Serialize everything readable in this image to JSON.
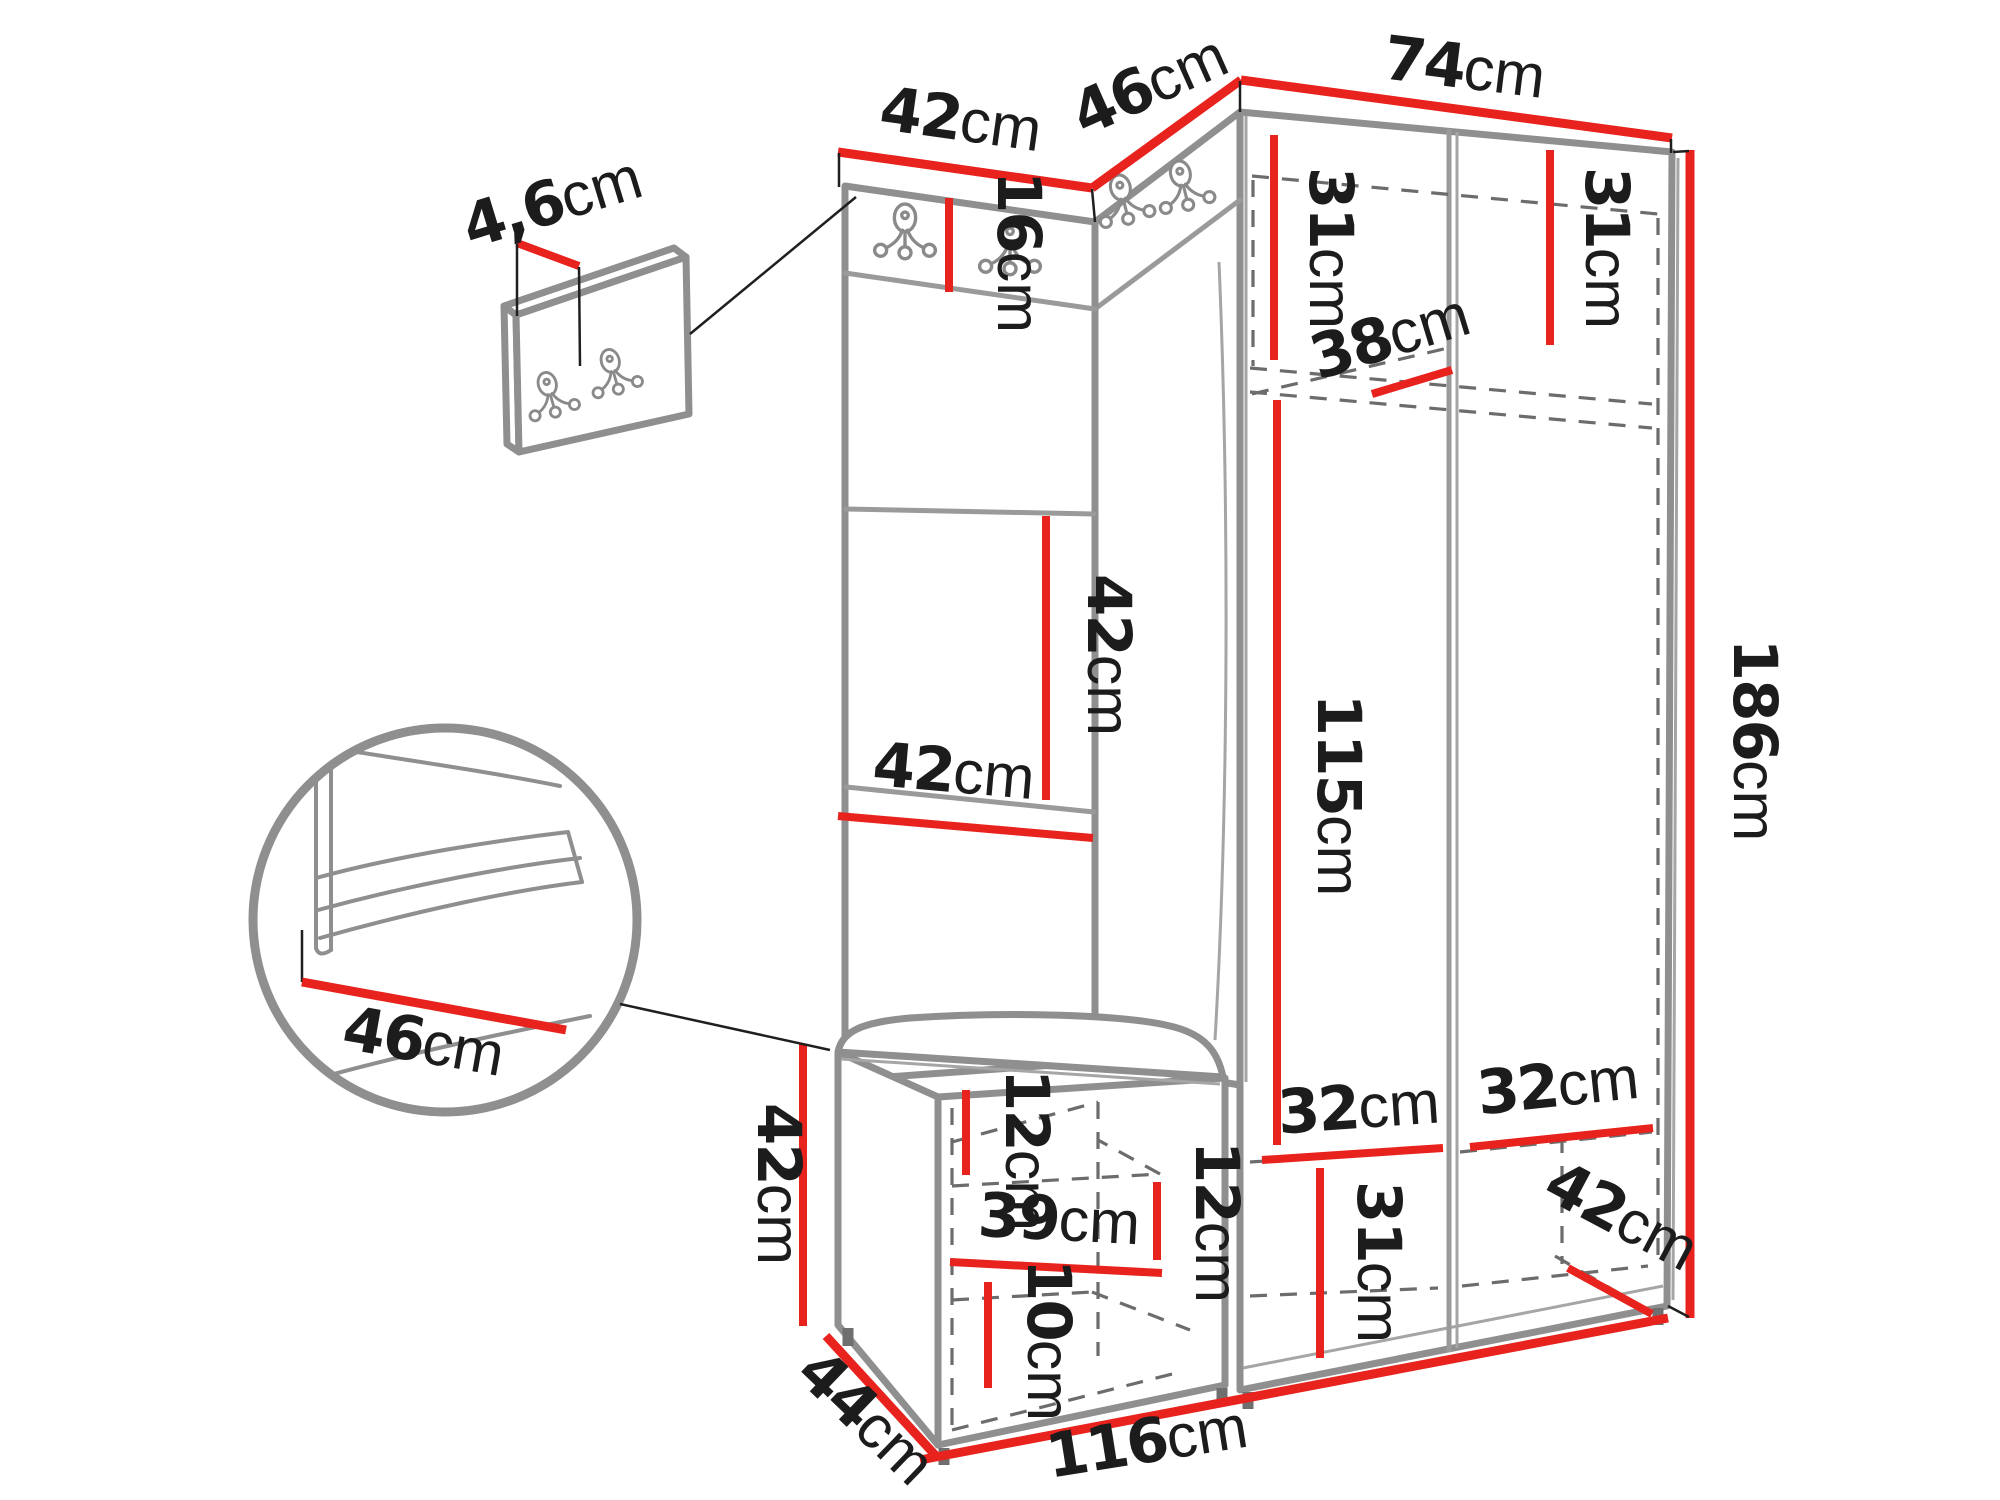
{
  "colors": {
    "accent": "#e8221c",
    "outline": "#8f8f8f",
    "label": "#1c1c1c"
  },
  "icons": {
    "coat_hook": "double-coat-hook-icon"
  },
  "dims": {
    "top_panel_width": {
      "value": "42",
      "unit": "cm"
    },
    "top_corner_width": {
      "value": "46",
      "unit": "cm"
    },
    "top_wardrobe_width": {
      "value": "74",
      "unit": "cm"
    },
    "hook_panel_thickness": {
      "value": "4,6",
      "unit": "cm"
    },
    "hook_strip_height": {
      "value": "16",
      "unit": "cm"
    },
    "shelf_left_height": {
      "value": "31",
      "unit": "cm"
    },
    "shelf_right_height": {
      "value": "31",
      "unit": "cm"
    },
    "shelf_depth": {
      "value": "38",
      "unit": "cm"
    },
    "panel_pad_height": {
      "value": "42",
      "unit": "cm"
    },
    "panel_width": {
      "value": "42",
      "unit": "cm"
    },
    "hanging_space_height": {
      "value": "115",
      "unit": "cm"
    },
    "total_height": {
      "value": "186",
      "unit": "cm"
    },
    "seat_depth": {
      "value": "46",
      "unit": "cm"
    },
    "bench_height": {
      "value": "42",
      "unit": "cm"
    },
    "bench_depth": {
      "value": "44",
      "unit": "cm"
    },
    "bench_cushion_height": {
      "value": "12",
      "unit": "cm"
    },
    "bench_inner_width": {
      "value": "39",
      "unit": "cm"
    },
    "bench_shelf_spacing": {
      "value": "12",
      "unit": "cm"
    },
    "bench_lower_height": {
      "value": "10",
      "unit": "cm"
    },
    "compartment_left_width": {
      "value": "32",
      "unit": "cm"
    },
    "compartment_right_width": {
      "value": "32",
      "unit": "cm"
    },
    "compartment_height": {
      "value": "31",
      "unit": "cm"
    },
    "wardrobe_depth": {
      "value": "42",
      "unit": "cm"
    },
    "total_width": {
      "value": "116",
      "unit": "cm"
    }
  }
}
